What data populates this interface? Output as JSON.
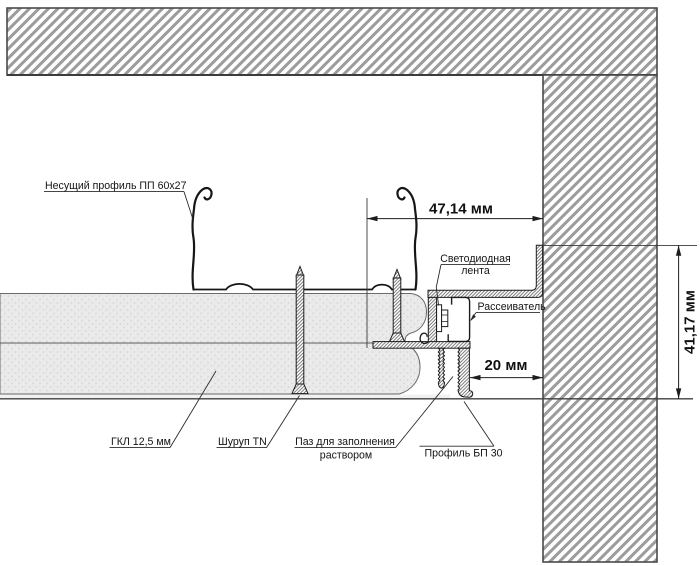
{
  "drawing": {
    "labels": {
      "carrier_profile": "Несущий профиль ПП 60x27",
      "led_strip_line1": "Светодиодная",
      "led_strip_line2": "лента",
      "diffuser": "Рассеиватель",
      "gkl": "ГКЛ 12,5 мм",
      "screw": "Шуруп TN",
      "groove_line1": "Паз для заполнения",
      "groove_line2": "раствором",
      "bp_profile": "Профиль БП 30"
    },
    "dimensions": {
      "top_width": "47,14 мм",
      "bottom_gap": "20 мм",
      "side_height": "41,17 мм"
    },
    "colors": {
      "hatch_stripe": "#9c9c9c",
      "metal_hatch": "#4f4f4f",
      "gypsum_fill": "#eaeaea",
      "outline": "#161616"
    }
  }
}
